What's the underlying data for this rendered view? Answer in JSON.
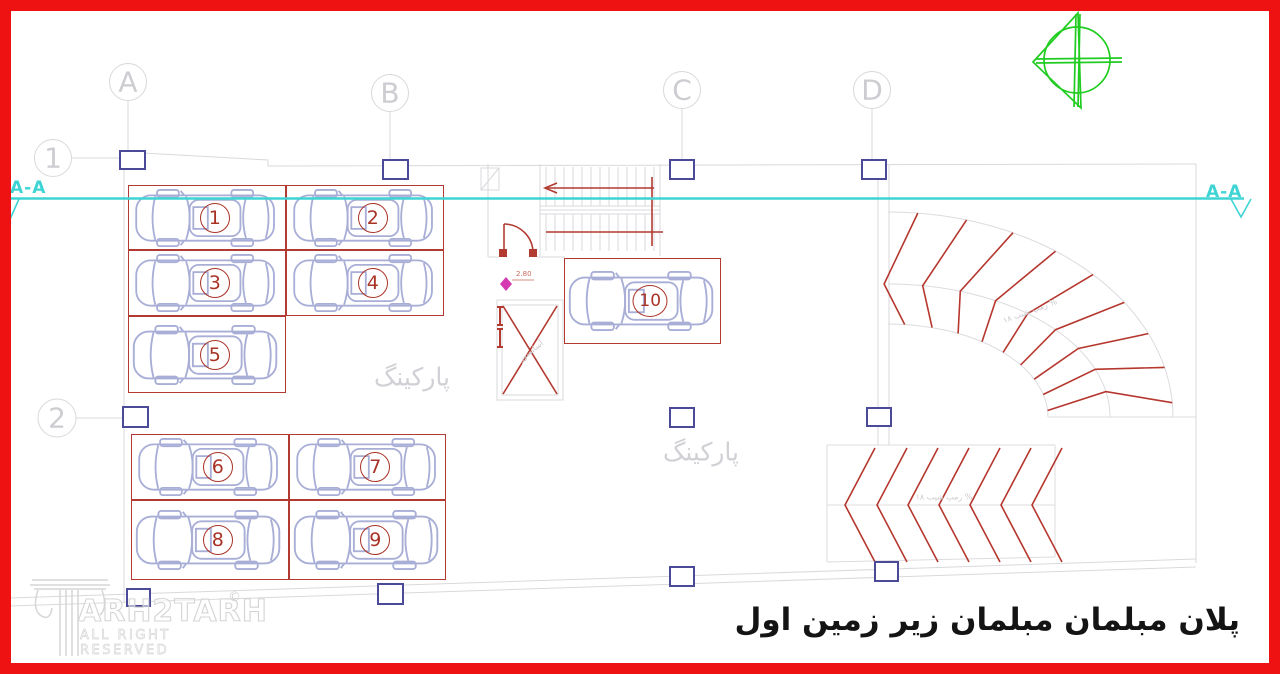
{
  "colors": {
    "frame_red": "#ee1212",
    "plan_red": "#b23a30",
    "number_red": "#a93226",
    "section_cyan": "#3ed4d4",
    "grid_gray": "#d9d9dd",
    "column_blue": "#4a4a99",
    "car_blue": "#a8aed6",
    "north_green": "#21cc21"
  },
  "grid": {
    "columns": [
      {
        "label": "A"
      },
      {
        "label": "B"
      },
      {
        "label": "C"
      },
      {
        "label": "D"
      }
    ],
    "rows": [
      {
        "label": "1"
      },
      {
        "label": "2"
      }
    ]
  },
  "section_line": {
    "left_label": "A-A",
    "right_label": "A-A"
  },
  "parking": {
    "watermark_upper": "پارکینگ",
    "watermark_lower": "پارکینگ",
    "spaces": [
      {
        "label": "1"
      },
      {
        "label": "2"
      },
      {
        "label": "3"
      },
      {
        "label": "4"
      },
      {
        "label": "5"
      },
      {
        "label": "6"
      },
      {
        "label": "7"
      },
      {
        "label": "8"
      },
      {
        "label": "9"
      },
      {
        "label": "10"
      }
    ]
  },
  "ramp": {
    "curved_label": "رمپ شیب ۱۸ %",
    "straight_label": "رمپ شیب ۱۸ %"
  },
  "elevator": {
    "label": "آسانسور"
  },
  "level_marker": {
    "value": "2.80"
  },
  "title": {
    "text": "پلان مبلمان مبلمان زیر زمین اول"
  },
  "logo": {
    "brand": "ARH2TARH",
    "reg": "©",
    "tagline": "ALL RIGHT RESERVED"
  }
}
